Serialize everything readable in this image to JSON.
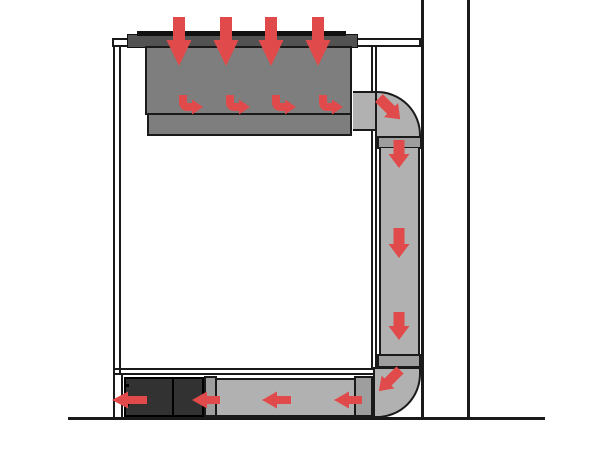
{
  "diagram": {
    "arrow_color": "#e14a4a",
    "surface_colors": {
      "bg": "#ffffff",
      "outline": "#1a1a1a",
      "counter": "#ffffff",
      "cooktop": "#525252",
      "glass": "#111111",
      "plenum": "#7e7e7e",
      "duct": "#b1b1b1",
      "flange": "#9e9e9e",
      "blower": "#323232"
    },
    "arrows": [
      {
        "name": "intake-down-arrow-1",
        "kind": "down",
        "x": 179,
        "y0": 17,
        "y1": 66,
        "shaft_w": 12,
        "head_w": 25,
        "head_l": 26
      },
      {
        "name": "intake-down-arrow-2",
        "kind": "down",
        "x": 226,
        "y0": 17,
        "y1": 66,
        "shaft_w": 12,
        "head_w": 25,
        "head_l": 26
      },
      {
        "name": "intake-down-arrow-3",
        "kind": "down",
        "x": 271,
        "y0": 17,
        "y1": 66,
        "shaft_w": 12,
        "head_w": 25,
        "head_l": 26
      },
      {
        "name": "intake-down-arrow-4",
        "kind": "down",
        "x": 318,
        "y0": 17,
        "y1": 66,
        "shaft_w": 12,
        "head_w": 25,
        "head_l": 26
      },
      {
        "name": "plenum-bent-arrow-1",
        "kind": "bent-right",
        "x": 183,
        "y0": 95,
        "elbow_y": 107,
        "tip_x": 203,
        "stroke_w": 8,
        "head_w": 15,
        "head_l": 11
      },
      {
        "name": "plenum-bent-arrow-2",
        "kind": "bent-right",
        "x": 230,
        "y0": 95,
        "elbow_y": 107,
        "tip_x": 250,
        "stroke_w": 8,
        "head_w": 15,
        "head_l": 11
      },
      {
        "name": "plenum-bent-arrow-3",
        "kind": "bent-right",
        "x": 276,
        "y0": 95,
        "elbow_y": 107,
        "tip_x": 296,
        "stroke_w": 8,
        "head_w": 15,
        "head_l": 11
      },
      {
        "name": "plenum-bent-arrow-4",
        "kind": "bent-right",
        "x": 323,
        "y0": 95,
        "elbow_y": 107,
        "tip_x": 343,
        "stroke_w": 8,
        "head_w": 15,
        "head_l": 11
      },
      {
        "name": "top-elbow-diagonal-arrow",
        "kind": "down",
        "x": 379,
        "y0": 98,
        "y1": 128,
        "shaft_w": 11,
        "head_w": 20,
        "head_l": 13,
        "angle": -45
      },
      {
        "name": "vertical-duct-down-arrow-1",
        "kind": "down",
        "x": 399,
        "y0": 140,
        "y1": 168,
        "shaft_w": 11,
        "head_w": 21,
        "head_l": 14
      },
      {
        "name": "vertical-duct-down-arrow-2",
        "kind": "down",
        "x": 399,
        "y0": 228,
        "y1": 258,
        "shaft_w": 11,
        "head_w": 21,
        "head_l": 14
      },
      {
        "name": "vertical-duct-down-arrow-3",
        "kind": "down",
        "x": 399,
        "y0": 312,
        "y1": 340,
        "shaft_w": 11,
        "head_w": 21,
        "head_l": 14
      },
      {
        "name": "bottom-elbow-diagonal-arrow",
        "kind": "down",
        "x": 400,
        "y0": 370,
        "y1": 400,
        "shaft_w": 10,
        "head_w": 18,
        "head_l": 13,
        "angle": 45
      },
      {
        "name": "horizontal-duct-left-arrow-1",
        "kind": "left",
        "y": 400,
        "tip_x": 334,
        "tail_x": 362,
        "shaft_w": 8,
        "head_w": 17,
        "head_l": 15
      },
      {
        "name": "horizontal-duct-left-arrow-2",
        "kind": "left",
        "y": 400,
        "tip_x": 262,
        "tail_x": 291,
        "shaft_w": 8,
        "head_w": 17,
        "head_l": 15
      },
      {
        "name": "horizontal-duct-left-arrow-3",
        "kind": "left",
        "y": 400,
        "tip_x": 192,
        "tail_x": 220,
        "shaft_w": 8,
        "head_w": 17,
        "head_l": 15
      },
      {
        "name": "outlet-left-arrow",
        "kind": "left",
        "y": 400,
        "tip_x": 112,
        "tail_x": 147,
        "shaft_w": 8,
        "head_w": 17,
        "head_l": 16
      }
    ]
  }
}
